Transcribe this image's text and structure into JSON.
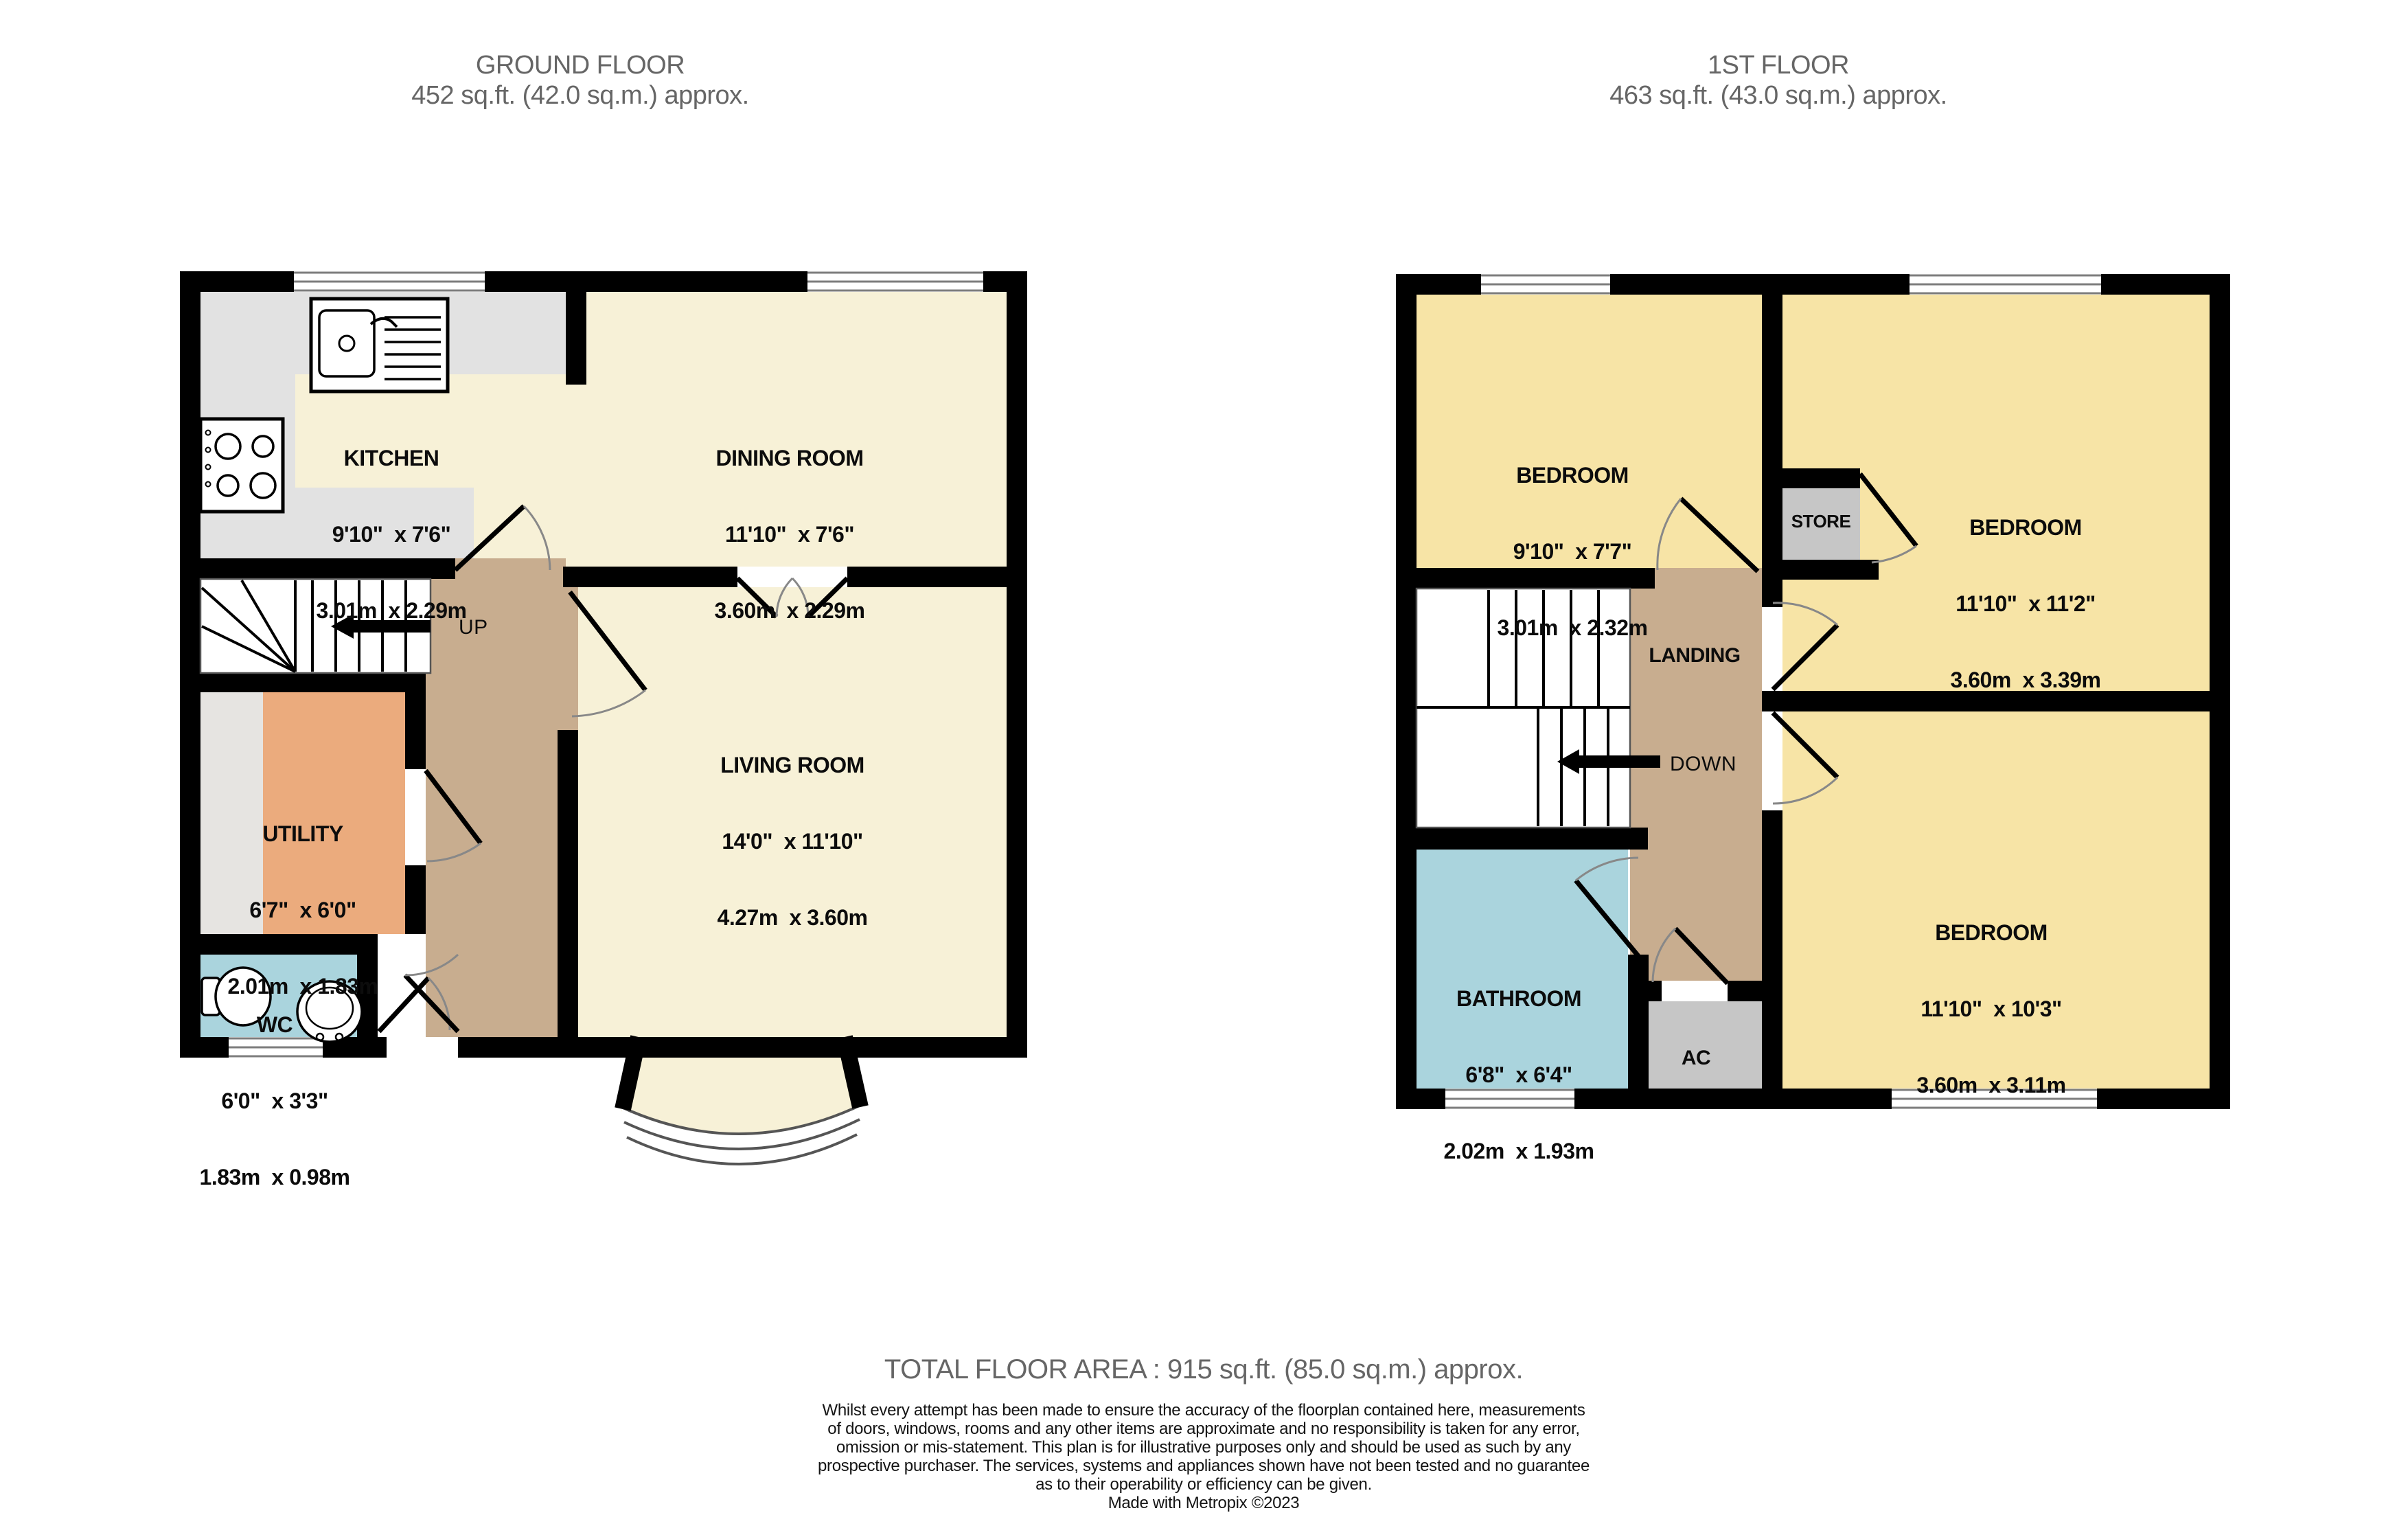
{
  "ground_floor": {
    "title": "GROUND FLOOR",
    "subtitle": "452 sq.ft. (42.0 sq.m.) approx.",
    "rooms": {
      "kitchen": {
        "name": "KITCHEN",
        "dims_imperial": "9'10\"  x 7'6\"",
        "dims_metric": "3.01m  x 2.29m"
      },
      "dining": {
        "name": "DINING ROOM",
        "dims_imperial": "11'10\"  x 7'6\"",
        "dims_metric": "3.60m  x 2.29m"
      },
      "living": {
        "name": "LIVING ROOM",
        "dims_imperial": "14'0\"  x 11'10\"",
        "dims_metric": "4.27m  x 3.60m"
      },
      "utility": {
        "name": "UTILITY",
        "dims_imperial": "6'7\"  x 6'0\"",
        "dims_metric": "2.01m  x 1.83m"
      },
      "wc": {
        "name": "WC",
        "dims_imperial": "6'0\"  x 3'3\"",
        "dims_metric": "1.83m  x 0.98m"
      }
    },
    "stairs_label": "UP"
  },
  "first_floor": {
    "title": "1ST FLOOR",
    "subtitle": "463 sq.ft. (43.0 sq.m.) approx.",
    "rooms": {
      "bedroom1": {
        "name": "BEDROOM",
        "dims_imperial": "9'10\"  x 7'7\"",
        "dims_metric": "3.01m  x 2.32m"
      },
      "bedroom2": {
        "name": "BEDROOM",
        "dims_imperial": "11'10\"  x 11'2\"",
        "dims_metric": "3.60m  x 3.39m"
      },
      "bedroom3": {
        "name": "BEDROOM",
        "dims_imperial": "11'10\"  x 10'3\"",
        "dims_metric": "3.60m  x 3.11m"
      },
      "bathroom": {
        "name": "BATHROOM",
        "dims_imperial": "6'8\"  x 6'4\"",
        "dims_metric": "2.02m  x 1.93m"
      },
      "store": {
        "name": "STORE"
      },
      "landing": {
        "name": "LANDING"
      },
      "ac": {
        "name": "AC"
      }
    },
    "stairs_label": "DOWN"
  },
  "footer": {
    "total": "TOTAL FLOOR AREA : 915 sq.ft. (85.0 sq.m.) approx.",
    "disclaimer_lines": [
      "Whilst every attempt has been made to ensure the accuracy of the floorplan contained here, measurements",
      "of doors, windows, rooms and any other items are approximate and no responsibility is taken for any error,",
      "omission or mis-statement. This plan is for illustrative purposes only and should be used as such by any",
      "prospective purchaser. The services, systems and appliances shown have not been tested and no guarantee",
      "as to their operability or efficiency can be given.",
      "Made with Metropix ©2023"
    ]
  },
  "colors": {
    "cream": "#F7F1D7",
    "bedroom_yellow": "#F7E4A6",
    "hall_brown": "#C8AD8F",
    "utility_orange": "#EBAB7D",
    "bath_blue": "#AAD4DD",
    "kitchen_gray": "#E2E2E2",
    "utility_gray": "#E6E4E1",
    "closet_gray": "#C6C6C6",
    "wall_black": "#000000",
    "stairs_white": "#FFFFFF",
    "title_gray": "#666666"
  }
}
